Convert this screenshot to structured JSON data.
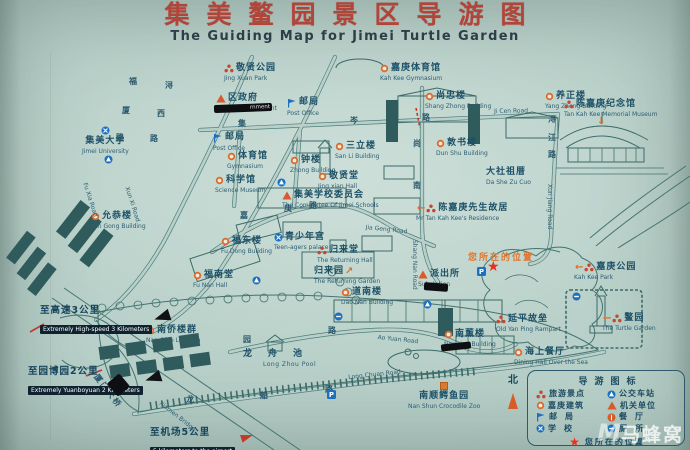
{
  "title": {
    "zh": "集美鳌园景区导游图",
    "en": "The Guiding Map for Jimei Turtle Garden"
  },
  "colors": {
    "title_red": "#b0453a",
    "label_blue": "#1d5067",
    "line_teal": "#4e7d7a",
    "icon_orange": "#d96c2e",
    "icon_red": "#c9452c",
    "icon_blue": "#1d6fc0",
    "star_red": "#e23222",
    "accent_orange": "#e0762e"
  },
  "pois": [
    {
      "zh": "敬贤公园",
      "en": "Jing Xuan Park",
      "icon": "attraction",
      "x": 224,
      "y": 63
    },
    {
      "zh": "区政府",
      "en": "District Government",
      "icon": "government",
      "x": 216,
      "y": 93
    },
    {
      "zh": "邮局",
      "en": "Post Office",
      "icon": "post",
      "x": 287,
      "y": 97
    },
    {
      "zh": "嘉庚体育馆",
      "en": "Kah Kee Gymnasium",
      "icon": "building",
      "x": 380,
      "y": 63
    },
    {
      "zh": "尚忠楼",
      "en": "Shang Zhong Building",
      "icon": "building",
      "x": 425,
      "y": 91
    },
    {
      "zh": "养正楼",
      "en": "Yang Zheng Building",
      "icon": "building",
      "x": 545,
      "y": 91
    },
    {
      "zh": "敦书楼",
      "en": "Dun Shu Building",
      "icon": "building",
      "x": 436,
      "y": 138
    },
    {
      "zh": "陈嘉庚纪念馆",
      "en": "Tan Kah Kee Memorial Museum",
      "icon": "attraction",
      "x": 564,
      "y": 99
    },
    {
      "zh": "集美大学",
      "en": "Jimei University",
      "icon": "school",
      "x": 82,
      "y": 126,
      "layout": "stack"
    },
    {
      "zh": "邮局",
      "en": "Post Office",
      "icon": "post",
      "x": 213,
      "y": 132
    },
    {
      "zh": "体育馆",
      "en": "Gymnasium",
      "icon": "building",
      "x": 227,
      "y": 151
    },
    {
      "zh": "科学馆",
      "en": "Science Museum",
      "icon": "building",
      "x": 215,
      "y": 175
    },
    {
      "zh": "钟楼",
      "en": "Zhong Building",
      "icon": "building",
      "x": 290,
      "y": 155
    },
    {
      "zh": "三立楼",
      "en": "San Li Building",
      "icon": "building",
      "x": 335,
      "y": 141
    },
    {
      "zh": "敬贤堂",
      "en": "Jing xian Hall",
      "icon": "building",
      "x": 318,
      "y": 171
    },
    {
      "zh": "集美学校委员会",
      "en": "The Committee Of Jimei Schools",
      "icon": "government",
      "x": 282,
      "y": 190
    },
    {
      "zh": "大社祖厝",
      "en": "Da She Zu Cuo",
      "icon": "none",
      "x": 486,
      "y": 167
    },
    {
      "zh": "陈嘉庚先生故居",
      "en": "Mr Tan Kah Kee's Residence",
      "icon": "attraction",
      "arrow": "left",
      "x": 416,
      "y": 203
    },
    {
      "zh": "允恭楼",
      "en": "Yun Gong Building",
      "icon": "building",
      "x": 91,
      "y": 211
    },
    {
      "zh": "福东楼",
      "en": "Fu Dong Building",
      "icon": "building",
      "x": 221,
      "y": 236
    },
    {
      "zh": "青少年宫",
      "en": "Teen-agers palace",
      "icon": "school",
      "x": 274,
      "y": 232
    },
    {
      "zh": "归来堂",
      "en": "The Returning Hall",
      "icon": "attraction",
      "x": 317,
      "y": 245
    },
    {
      "zh": "归来园",
      "en": "The Returning Garden",
      "icon": "none",
      "arrow": "ne",
      "arrow_pos": "right",
      "x": 314,
      "y": 266
    },
    {
      "zh": "派出所",
      "en": "Substation",
      "icon": "government",
      "x": 418,
      "y": 269
    },
    {
      "zh": "道南楼",
      "en": "Dao Nan Building",
      "icon": "building",
      "x": 341,
      "y": 287
    },
    {
      "zh": "福南堂",
      "en": "Fu Nan Hall",
      "icon": "building",
      "x": 193,
      "y": 270
    },
    {
      "zh": "南侨楼群",
      "en": "Nan Qiao Lou Qun",
      "icon": "building",
      "x": 146,
      "y": 325
    },
    {
      "zh": "龙舟池",
      "en": "Long Zhou Pool",
      "icon": "none",
      "x": 243,
      "y": 349,
      "layout": "spread"
    },
    {
      "zh": "南薰楼",
      "en": "Nan Xun Building",
      "icon": "building",
      "x": 444,
      "y": 329
    },
    {
      "zh": "延平故垒",
      "en": "Old Yan Ping Rampart",
      "icon": "attraction",
      "x": 496,
      "y": 314
    },
    {
      "zh": "海上餐厅",
      "en": "Dining Hall Over the Sea",
      "icon": "building",
      "x": 514,
      "y": 347
    },
    {
      "zh": "南顺鳄鱼园",
      "en": "Nan Shun Crocodile Zoo",
      "icon": "zoo",
      "x": 408,
      "y": 382,
      "layout": "stack"
    },
    {
      "zh": "鳌园",
      "en": "The Turtle Garden",
      "icon": "attraction",
      "arrow": "left",
      "x": 602,
      "y": 313
    },
    {
      "zh": "嘉庚公园",
      "en": "Kah Kee Park",
      "icon": "attraction",
      "arrow": "left",
      "x": 574,
      "y": 262
    }
  ],
  "road_labels": [
    {
      "t": "福",
      "x": 129,
      "y": 76,
      "cls": "c"
    },
    {
      "t": "厦",
      "x": 122,
      "y": 105,
      "cls": "c"
    },
    {
      "t": "路",
      "x": 116,
      "y": 132,
      "cls": "c"
    },
    {
      "t": "Fu Xia Road",
      "x": 88,
      "y": 182,
      "rot": 72,
      "cls": "e"
    },
    {
      "t": "浔",
      "x": 165,
      "y": 80,
      "cls": "c"
    },
    {
      "t": "西",
      "x": 157,
      "y": 108,
      "cls": "c"
    },
    {
      "t": "路",
      "x": 150,
      "y": 133,
      "cls": "c"
    },
    {
      "t": "Xun Xi Road",
      "x": 130,
      "y": 186,
      "rot": 72,
      "cls": "e"
    },
    {
      "t": "集",
      "x": 238,
      "y": 118,
      "cls": "c"
    },
    {
      "t": "岑",
      "x": 350,
      "y": 115,
      "cls": "c"
    },
    {
      "t": "路",
      "x": 422,
      "y": 112,
      "cls": "c"
    },
    {
      "t": "Ji Cen Road",
      "x": 494,
      "y": 108,
      "rot": -1,
      "cls": "e"
    },
    {
      "t": "尚",
      "x": 413,
      "y": 138,
      "cls": "c"
    },
    {
      "t": "南",
      "x": 413,
      "y": 180,
      "cls": "c"
    },
    {
      "t": "Shang Nan Road",
      "x": 418,
      "y": 240,
      "rot": 90,
      "cls": "e"
    },
    {
      "t": "浔",
      "x": 548,
      "y": 114,
      "cls": "c"
    },
    {
      "t": "江",
      "x": 548,
      "y": 132,
      "cls": "c"
    },
    {
      "t": "路",
      "x": 548,
      "y": 149,
      "cls": "c"
    },
    {
      "t": "Xun Jiang Road",
      "x": 553,
      "y": 184,
      "rot": 90,
      "cls": "e"
    },
    {
      "t": "嘉",
      "x": 240,
      "y": 210,
      "cls": "c"
    },
    {
      "t": "庚",
      "x": 284,
      "y": 203,
      "cls": "c"
    },
    {
      "t": "路",
      "x": 309,
      "y": 200,
      "cls": "c"
    },
    {
      "t": "Jia Geng Road",
      "x": 366,
      "y": 224,
      "rot": 6,
      "cls": "e"
    },
    {
      "t": "园",
      "x": 243,
      "y": 334,
      "cls": "c"
    },
    {
      "t": "路",
      "x": 328,
      "y": 325,
      "cls": "c"
    },
    {
      "t": "Ao Yuan Road",
      "x": 378,
      "y": 334,
      "rot": 6,
      "cls": "e"
    },
    {
      "t": "龙",
      "x": 186,
      "y": 394,
      "cls": "c"
    },
    {
      "t": "船",
      "x": 260,
      "y": 390,
      "cls": "c"
    },
    {
      "t": "路",
      "x": 325,
      "y": 384,
      "cls": "c"
    },
    {
      "t": "Long Chuan Road",
      "x": 348,
      "y": 374,
      "rot": -6,
      "cls": "e"
    },
    {
      "t": "厦门大桥",
      "x": 100,
      "y": 372,
      "rot": 52,
      "cls": "c2"
    },
    {
      "t": "Xiamen Bridge",
      "x": 162,
      "y": 400,
      "rot": 38,
      "cls": "e"
    }
  ],
  "facilities": [
    {
      "type": "bus",
      "x": 104,
      "y": 155
    },
    {
      "type": "bus",
      "x": 277,
      "y": 178
    },
    {
      "type": "bus",
      "x": 252,
      "y": 276
    },
    {
      "type": "bus",
      "x": 423,
      "y": 300
    },
    {
      "type": "toilet",
      "x": 572,
      "y": 292
    },
    {
      "type": "toilet",
      "x": 334,
      "y": 312
    },
    {
      "type": "parking",
      "x": 327,
      "y": 390
    },
    {
      "type": "parking",
      "x": 477,
      "y": 267
    }
  ],
  "marks": [
    {
      "char": "↓",
      "x": 597,
      "y": 116
    }
  ],
  "your_location": {
    "label": "您所在的位置",
    "x": 468,
    "y": 250,
    "star_x": 487,
    "star_y": 261
  },
  "distances": [
    {
      "zh": "至高速3公里",
      "en": "Extremely High-speed 3 Kilometers",
      "x": 40,
      "y": 302,
      "arrow": "black"
    },
    {
      "zh": "至园博园2公里",
      "en": "Extremely Yuanboyuan 2 Kilometers",
      "x": 28,
      "y": 363,
      "arrow": "black"
    },
    {
      "zh": "至机场5公里",
      "en": "5 kilometers to the airport",
      "x": 150,
      "y": 424,
      "arrow": "red"
    }
  ],
  "legend": {
    "title": "导游图标",
    "items": [
      {
        "icon": "attraction",
        "label": "旅游景点"
      },
      {
        "icon": "bus",
        "label": "公交车站"
      },
      {
        "icon": "building",
        "label": "嘉庚建筑"
      },
      {
        "icon": "government",
        "label": "机关单位"
      },
      {
        "icon": "post",
        "label": "邮局",
        "spaced": true
      },
      {
        "icon": "restaurant",
        "label": "餐厅",
        "spaced": true
      },
      {
        "icon": "school",
        "label": "学校",
        "spaced": true
      },
      {
        "icon": "toilet",
        "label": "厕所",
        "spaced": true
      }
    ],
    "footer_label": "您所在的位置"
  },
  "compass": {
    "north": "北"
  },
  "watermark": {
    "logo": "M",
    "text": "马蜂窝"
  },
  "smudges": [
    {
      "x": 214,
      "y": 104,
      "w": 54,
      "h": 8,
      "rot": -2,
      "text": "rnment"
    },
    {
      "x": 424,
      "y": 283,
      "w": 20,
      "h": 8,
      "rot": 4,
      "text": ""
    },
    {
      "x": 441,
      "y": 343,
      "w": 26,
      "h": 7,
      "rot": -6,
      "text": ""
    },
    {
      "x": 110,
      "y": 377,
      "w": 13,
      "h": 16,
      "rot": 50,
      "text": ""
    }
  ]
}
